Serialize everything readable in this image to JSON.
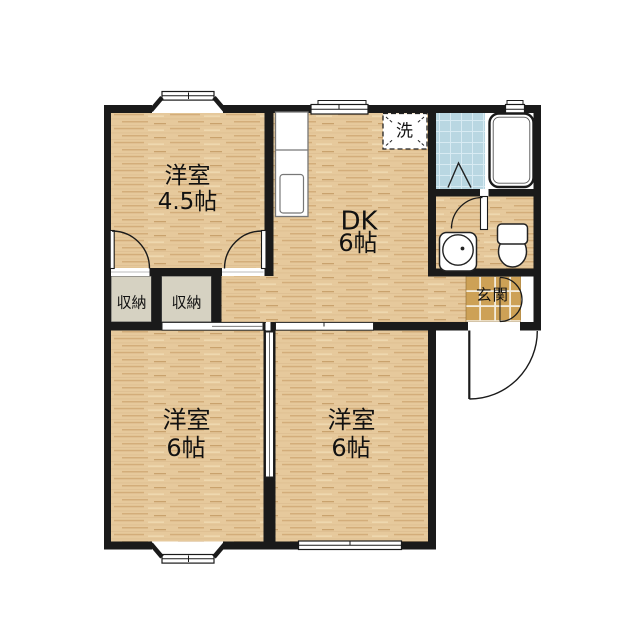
{
  "colors": {
    "wall": "#1a1a1a",
    "wood": "#e6c99c",
    "wood_streak": "#d3ad7a",
    "bath_tile": "#b9d7e2",
    "entrance_tile": "#cda156",
    "closet": "#d6d2c2"
  },
  "rooms": {
    "western1": {
      "label": "洋室",
      "size": "4.5帖"
    },
    "dk": {
      "label": "DK",
      "size": "6帖"
    },
    "western2": {
      "label": "洋室",
      "size": "6帖"
    },
    "western3": {
      "label": "洋室",
      "size": "6帖"
    }
  },
  "labels": {
    "closet1": "収納",
    "closet2": "収納",
    "entrance": "玄関",
    "laundry": "洗"
  }
}
